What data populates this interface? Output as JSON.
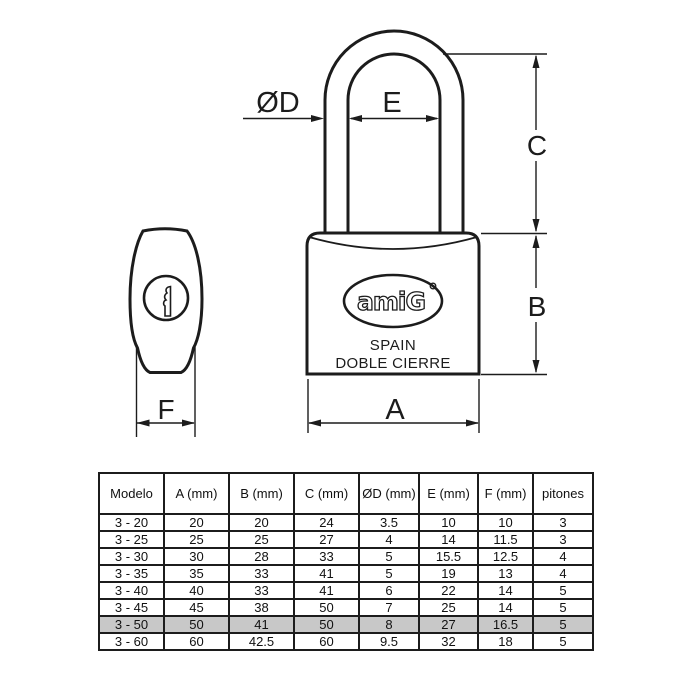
{
  "drawing": {
    "dimension_labels": {
      "shackle_diameter": "ØD",
      "shackle_inner_width": "E",
      "shackle_height": "C",
      "body_height": "B",
      "body_width": "A",
      "body_depth": "F"
    },
    "logo": {
      "brand": "amiG",
      "country": "SPAIN",
      "subtitle": "DOBLE CIERRE"
    }
  },
  "table": {
    "headers": [
      "Modelo",
      "A (mm)",
      "B (mm)",
      "C (mm)",
      "ØD (mm)",
      "E (mm)",
      "F (mm)",
      "pitones"
    ],
    "rows": [
      {
        "cells": [
          "3 - 20",
          "20",
          "20",
          "24",
          "3.5",
          "10",
          "10",
          "3"
        ],
        "highlighted": false
      },
      {
        "cells": [
          "3 - 25",
          "25",
          "25",
          "27",
          "4",
          "14",
          "11.5",
          "3"
        ],
        "highlighted": false
      },
      {
        "cells": [
          "3 - 30",
          "30",
          "28",
          "33",
          "5",
          "15.5",
          "12.5",
          "4"
        ],
        "highlighted": false
      },
      {
        "cells": [
          "3 - 35",
          "35",
          "33",
          "41",
          "5",
          "19",
          "13",
          "4"
        ],
        "highlighted": false
      },
      {
        "cells": [
          "3 - 40",
          "40",
          "33",
          "41",
          "6",
          "22",
          "14",
          "5"
        ],
        "highlighted": false
      },
      {
        "cells": [
          "3 - 45",
          "45",
          "38",
          "50",
          "7",
          "25",
          "14",
          "5"
        ],
        "highlighted": false
      },
      {
        "cells": [
          "3 - 50",
          "50",
          "41",
          "50",
          "8",
          "27",
          "16.5",
          "5"
        ],
        "highlighted": true
      },
      {
        "cells": [
          "3 - 60",
          "60",
          "42.5",
          "60",
          "9.5",
          "32",
          "18",
          "5"
        ],
        "highlighted": false
      }
    ],
    "highlight_color": "#c8c8c8"
  },
  "colors": {
    "line": "#1c1c1c",
    "background": "#ffffff"
  }
}
